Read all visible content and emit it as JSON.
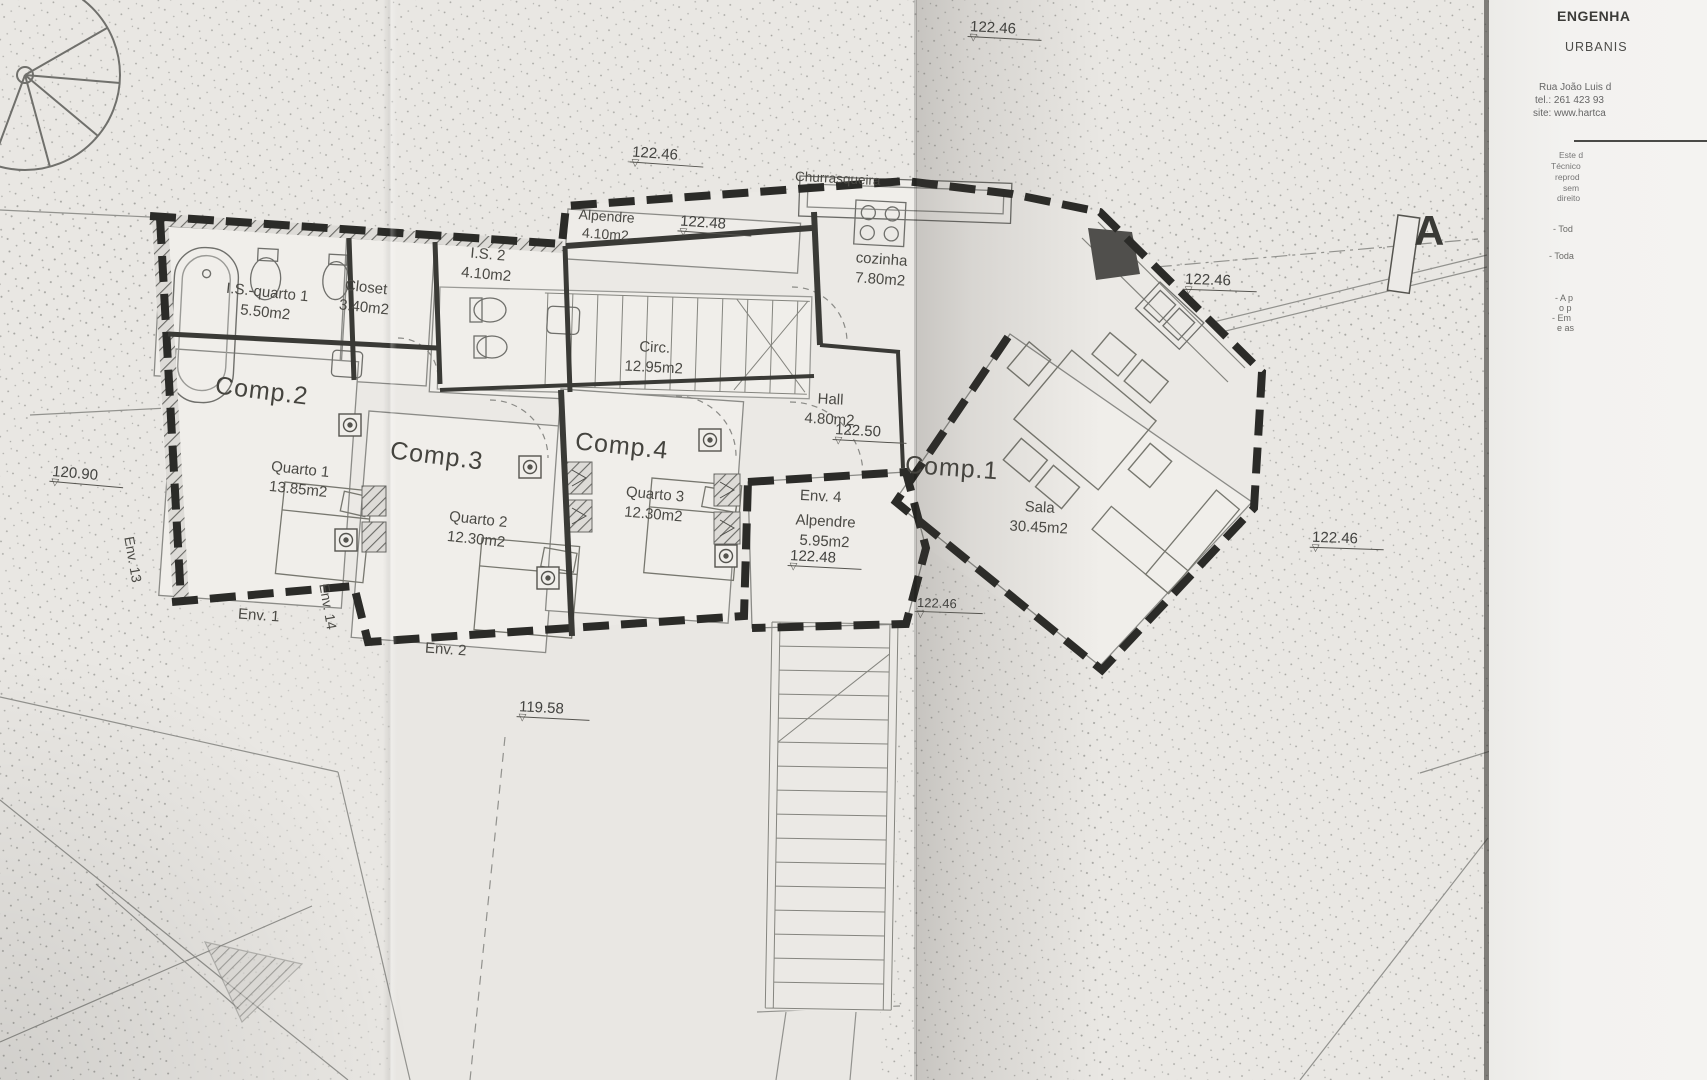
{
  "plan": {
    "rooms": {
      "is_quarto1": {
        "name": "I.S.-quarto 1",
        "area": "5.50m2"
      },
      "closet": {
        "name": "Closet",
        "area": "3.40m2"
      },
      "is2": {
        "name": "I.S. 2",
        "area": "4.10m2"
      },
      "alpendre_top": {
        "name": "Alpendre",
        "area": "4.10m2"
      },
      "churrasqueira": {
        "name": "Churrasqueira"
      },
      "cozinha": {
        "name": "cozinha",
        "area": "7.80m2"
      },
      "circ": {
        "name": "Circ.",
        "area": "12.95m2"
      },
      "hall": {
        "name": "Hall",
        "area": "4.80m2"
      },
      "comp2": {
        "name": "Comp.2"
      },
      "quarto1": {
        "name": "Quarto 1",
        "area": "13.85m2"
      },
      "comp3": {
        "name": "Comp.3"
      },
      "quarto2": {
        "name": "Quarto 2",
        "area": "12.30m2"
      },
      "comp4": {
        "name": "Comp.4"
      },
      "quarto3": {
        "name": "Quarto 3",
        "area": "12.30m2"
      },
      "env4_alpendre": {
        "name": "Alpendre",
        "area": "5.95m2"
      },
      "comp1": {
        "name": "Comp.1"
      },
      "sala": {
        "name": "Sala",
        "area": "30.45m2"
      }
    },
    "envelopes": {
      "env1": "Env. 1",
      "env2": "Env. 2",
      "env4": "Env. 4",
      "env13": "Env. 13",
      "env14": "Env. 14"
    },
    "levels": {
      "l1": "122.46",
      "l2": "122.46",
      "l3": "122.48",
      "l4": "122.50",
      "l5": "122.46",
      "l6": "122.46",
      "l7": "122.48",
      "l8": "122.46",
      "l9": "120.90",
      "l10": "119.58"
    },
    "section_marker": "A"
  },
  "title_block": {
    "discipline": "ENGENHA",
    "subtitle": "URBANIS",
    "address": "Rua João Luis d",
    "phone": "tel.: 261 423 93",
    "website": "site: www.hartca",
    "fine_print": {
      "f1": "Este d",
      "f2": "Técnico",
      "f3": "reprod",
      "f4": "sem",
      "f5": "direito"
    },
    "notes": {
      "n1": "- Tod",
      "n2": "- Toda",
      "n3": "- A p",
      "n4": "o p",
      "n5": "- Em",
      "n6": "e as"
    }
  }
}
